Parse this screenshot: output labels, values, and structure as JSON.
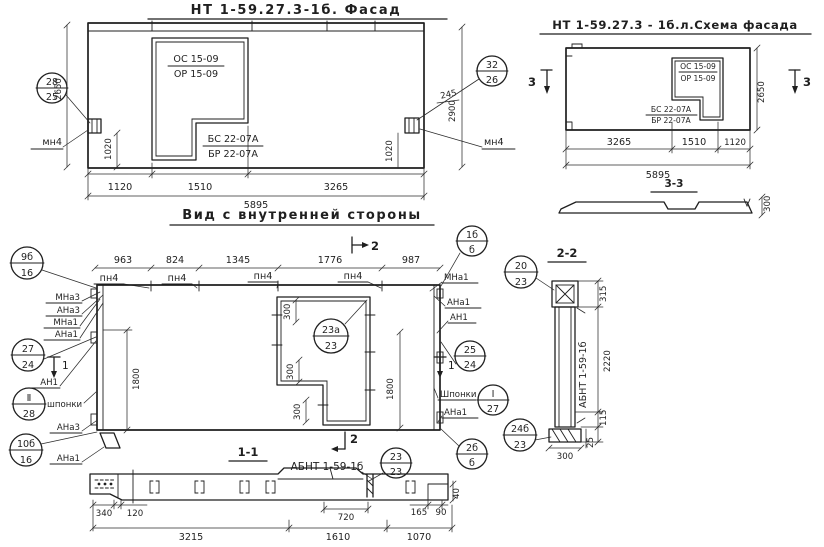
{
  "colors": {
    "ink": "#1f1f1f",
    "paper": "#ffffff"
  },
  "facade": {
    "title": "НТ 1-59.27.3-1б. Фасад",
    "window_mark_1": "ОС 15-09",
    "window_mark_2": "ОР 15-09",
    "panel_mark_1": "БС 22-07А",
    "panel_mark_2": "БР 22-07А",
    "callout_left_top": "28",
    "callout_left_bottom": "25",
    "callout_right_top": "32",
    "callout_right_bottom": "26",
    "anchor_label": "мн4",
    "dim_height": "2650",
    "dim_height_full": "2900",
    "dim_245": "245",
    "dim_1020": "1020",
    "dims_bottom": [
      "1120",
      "1510",
      "3265"
    ],
    "dim_total": "5895"
  },
  "scheme": {
    "title": "НТ 1-59.27.3 - 1б.л.Схема фасада",
    "window_mark_1": "ОС 15-09",
    "window_mark_2": "ОР 15-09",
    "panel_mark_1": "БС 22-07А",
    "panel_mark_2": "БР 22-07А",
    "cut_label": "3",
    "dim_height": "2650",
    "dims_bottom": [
      "3265",
      "1510",
      "1120"
    ],
    "dim_total": "5895",
    "section_title": "3-3",
    "dim_thickness": "300"
  },
  "inner": {
    "title": "Вид с внутренней стороны",
    "dims_top": [
      "963",
      "824",
      "1345",
      "1776",
      "987"
    ],
    "hinge_label": "пн4",
    "cut2_label": "2",
    "cut1_label": "1",
    "dim_300": "300",
    "dim_1800": "1800",
    "opening_callout_top": "23а",
    "opening_callout_bottom": "23",
    "left": {
      "c1_top": "9б",
      "c1_bottom": "16",
      "mna3": "МНа3",
      "ana3": "АНа3",
      "mna1": "МНа1",
      "ana1": "АНа1",
      "c2_top": "27",
      "c2_bottom": "24",
      "an1": "АН1",
      "c3_top": "Ⅱ",
      "c3_bottom": "28",
      "keys": "шпонки",
      "ana3_b": "АНа3",
      "c4_top": "10б",
      "c4_bottom": "16",
      "ana1_b": "АНа1"
    },
    "right": {
      "c1_top": "1б",
      "c1_bottom": "б",
      "mna1": "МНа1",
      "ana1": "АНа1",
      "an1": "АН1",
      "c2_top": "25",
      "c2_bottom": "24",
      "keys": "Шпонки",
      "c3_top": "Ⅰ",
      "c3_bottom": "27",
      "ana1_b": "АНа1",
      "c4_top": "2б",
      "c4_bottom": "б",
      "c20_top": "20",
      "c20_bottom": "23",
      "c24_top": "24б",
      "c24_bottom": "23"
    }
  },
  "section11": {
    "title": "1-1",
    "beam_label": "АБНТ 1-59-1б",
    "callout_top": "23",
    "callout_bottom": "23",
    "cut2_label": "2",
    "dim_340": "340",
    "dim_120": "120",
    "dim_720": "720",
    "dim_165": "165",
    "dim_90": "90",
    "dim_40": "40",
    "dims_bottom": [
      "3215",
      "1610",
      "1070"
    ]
  },
  "section22": {
    "title": "2-2",
    "panel_label": "АБНТ 1-59-1б",
    "dim_315": "315",
    "dim_2220": "2220",
    "dim_115": "115",
    "dim_25": "25",
    "dim_300": "300"
  }
}
